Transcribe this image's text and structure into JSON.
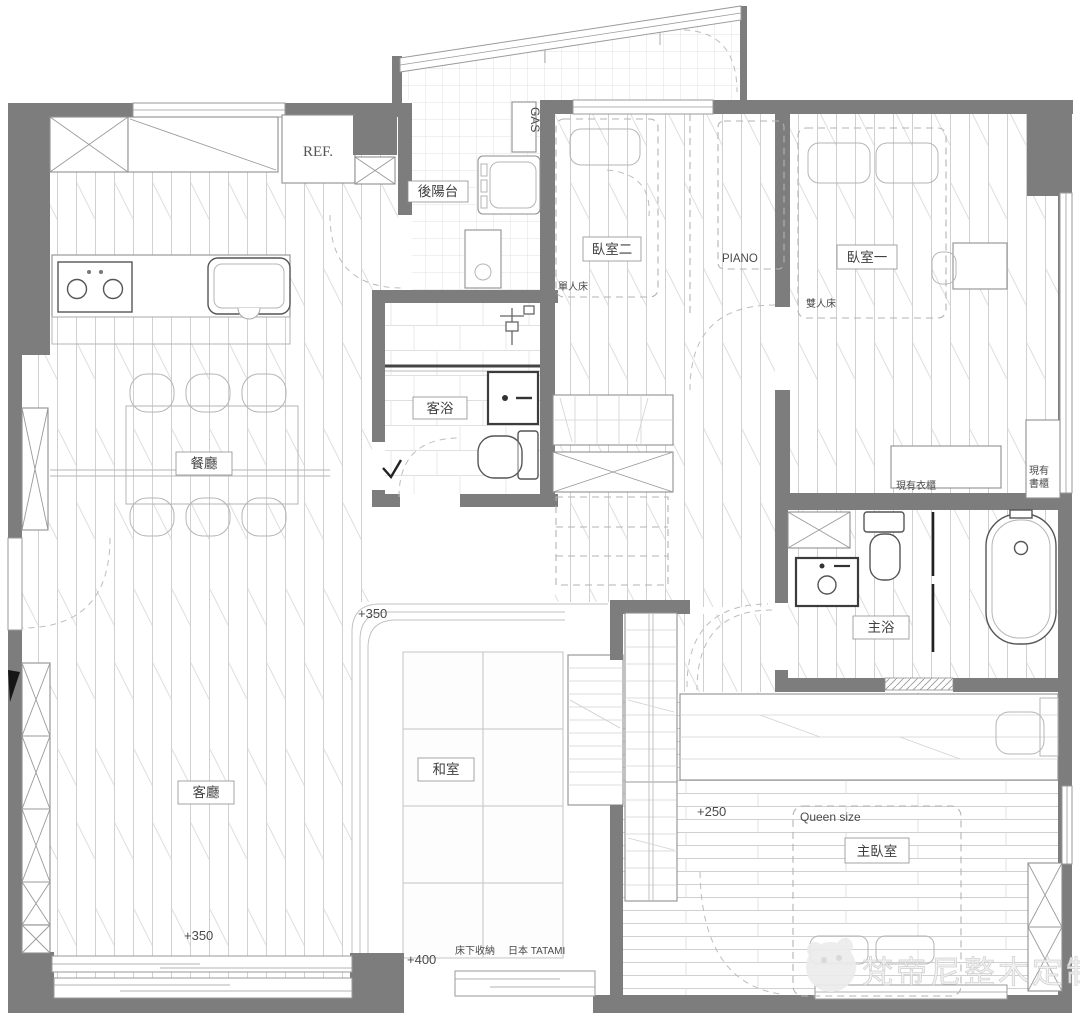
{
  "meta": {
    "drawing_type": "apartment floor plan"
  },
  "rooms": {
    "back_balcony": "後陽台",
    "bedroom2": "臥室二",
    "bedroom1": "臥室一",
    "guest_bath": "客浴",
    "dining": "餐廳",
    "living": "客廳",
    "tatami": "和室",
    "master_bath": "主浴",
    "master_bedroom": "主臥室"
  },
  "annotations": {
    "ref": "REF.",
    "gas": "GAS",
    "piano": "PIANO",
    "single_bed": "單人床",
    "double_bed": "雙人床",
    "existing_wardrobe": "現有衣櫃",
    "existing_bookcase_1": "現有",
    "existing_bookcase_2": "書櫃",
    "queen_size": "Queen size",
    "under_bed_storage": "床下收納",
    "japan_tatami": "日本 TATAMI"
  },
  "levels": {
    "tatami_entry": "+350",
    "living": "+350",
    "master_bedroom": "+250",
    "tatami": "+400"
  },
  "watermark": {
    "brand": "梵帝尼整木定制"
  },
  "colors": {
    "wall": "#7d7d7d",
    "furniture_line": "#8f8f8f",
    "floor_line": "#d0d0d0",
    "fixture_dark": "#3c3c3c",
    "label_text": "#3f3f3f",
    "watermark": "#f0f0f0"
  }
}
